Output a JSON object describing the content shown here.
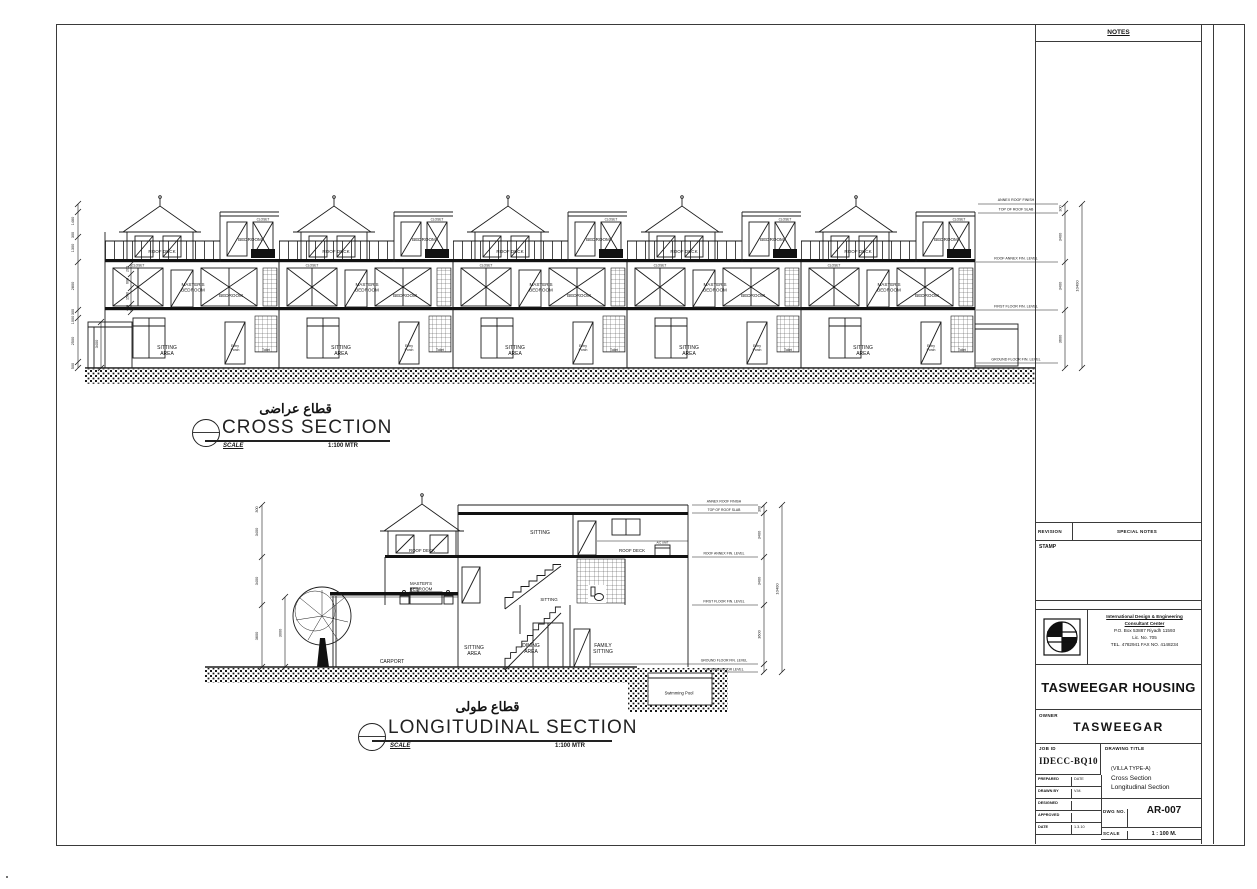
{
  "sheet": {
    "notes_label": "NOTES",
    "revision_label": "REVISION",
    "special_notes_label": "SPECIAL NOTES",
    "stamp_label": "STAMP",
    "company_name_1": "International Design & Engineering",
    "company_name_2": "Consultant Center",
    "company_address": "P.O. Box 53887  Riyadh 11593",
    "company_license": "Lic. No. 705",
    "company_tel": "TEL. 4782941    FAX NO. 4148234",
    "project_title": "TASWEEGAR HOUSING",
    "owner_label": "OWNER",
    "owner_name": "TASWEEGAR",
    "job_id_label": "JOB ID",
    "job_id": "IDECC-BQ10",
    "drawing_title_label": "DRAWING TITLE",
    "drawing_title_1": "(VILLA TYPE-A)",
    "drawing_title_2": "Cross Section",
    "drawing_title_3": "Longitudinal Section",
    "approval_rows": [
      {
        "label": "PREPARED",
        "value": "DATE"
      },
      {
        "label": "DRAWN BY",
        "value": "V.M."
      },
      {
        "label": "DESIGNED",
        "value": ""
      },
      {
        "label": "APPROVED",
        "value": ""
      },
      {
        "label": "DATE",
        "value": "1.3.10"
      }
    ],
    "dwg_no_label": "DWG NO.",
    "dwg_no": "AR-007",
    "scale_label": "SCALE",
    "scale_value": "1 : 100 M."
  },
  "levels": [
    "ANNEX ROOF FINISH",
    "TOP OF ROOF SLAB",
    "ROOF ANNEX FIN. LEVEL",
    "FIRST FLOOR FIN. LEVEL",
    "GROUND FLOOR FIN. LEVEL",
    "GROUND FLOOR LEVEL"
  ],
  "rooms": {
    "roof_deck": "ROOF DECK",
    "bedroom": "BEDROOM",
    "closet": "CLOSET",
    "masters_bedroom": "MASTER'S BEDROOM",
    "sitting_area": "SITTING AREA",
    "entry_porch": "Entry Porch",
    "toilet": "Toilet",
    "sitting": "SITTING",
    "carport": "CARPORT",
    "dining_area": "DINING AREA",
    "family_sitting": "FAMILY SITTING",
    "swimming_pool": "Swimming Pool",
    "ac_unit": "A/C UNIT"
  },
  "cross_section": {
    "title_ar": "قطاع عراضى",
    "title_en": "CROSS SECTION",
    "scale_label": "SCALE",
    "scale_value": "1:100 MTR",
    "dims_left": [
      "1460",
      "300",
      "1300",
      "2800",
      "300",
      "1000",
      "2500",
      "500"
    ],
    "dims_inner": [
      "200",
      "600",
      "1500",
      "450"
    ],
    "porch_dim": "3400",
    "dims_right": [
      "300",
      "3400",
      "3400",
      "3600"
    ],
    "dim_total": "10400"
  },
  "longitudinal_section": {
    "title_ar": "قطاع طولى",
    "title_en": "LONGITUDINAL SECTION",
    "scale_label": "SCALE",
    "scale_value": "1:100 MTR",
    "dims_left": [
      "300",
      "3400",
      "3400",
      "3600"
    ],
    "carport_dim": "3000",
    "dims_right": [
      "300",
      "3400",
      "3400",
      "3600"
    ],
    "dim_total": "10400"
  }
}
